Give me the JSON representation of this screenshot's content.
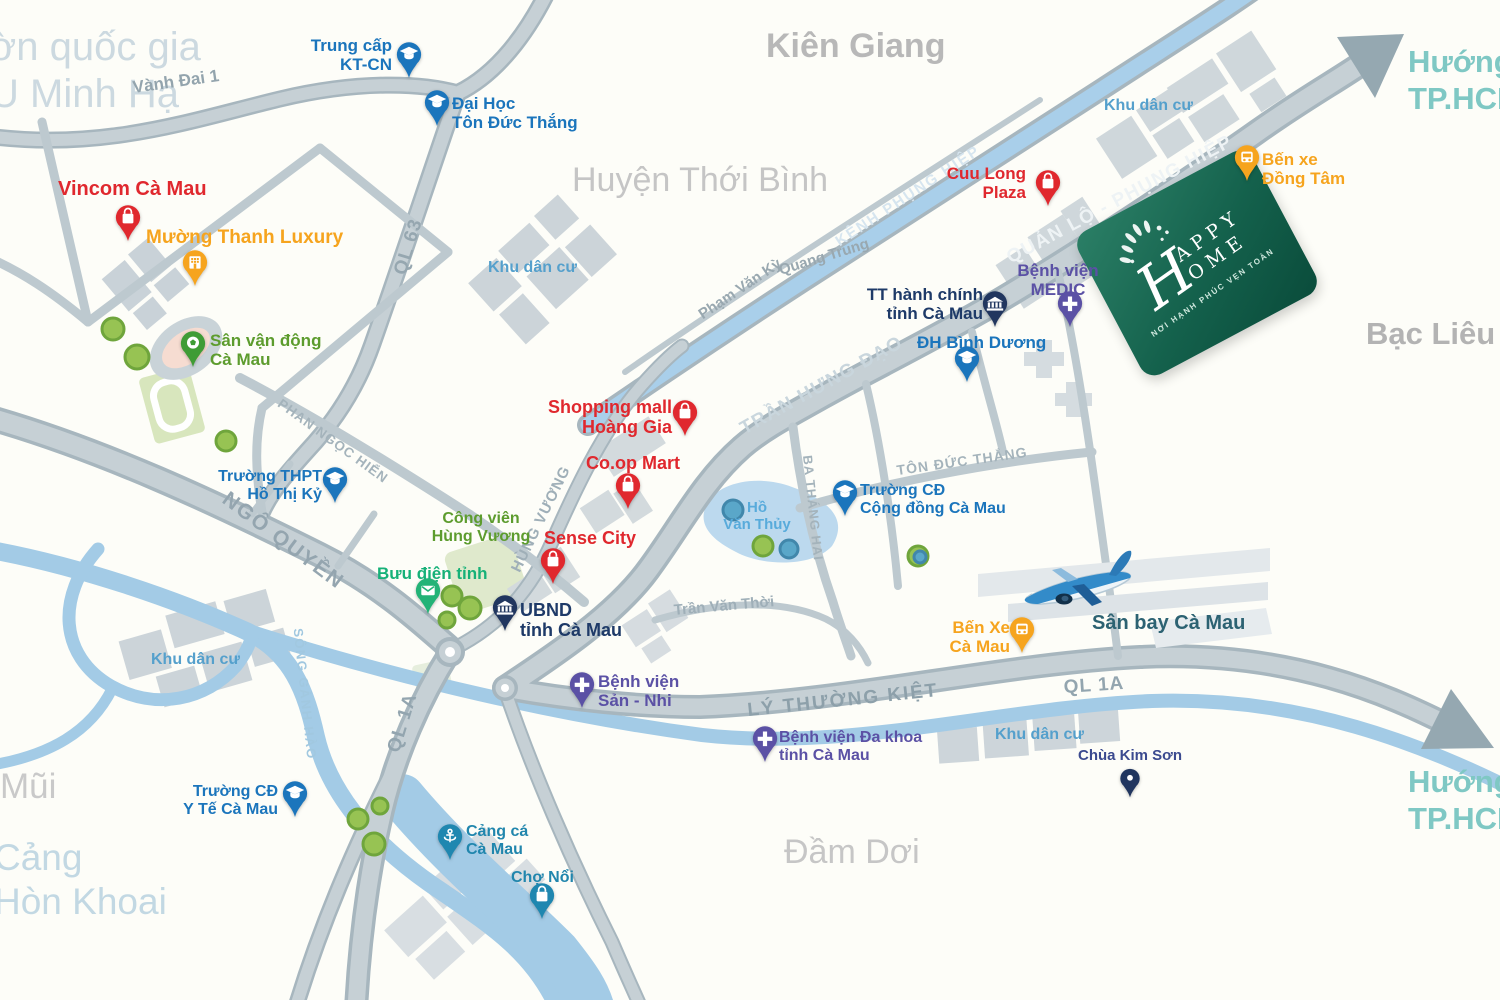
{
  "project": {
    "brand_initial": "H",
    "brand_line1": "APPY",
    "brand_line2": "OME",
    "tagline": "NƠI HẠNH PHÚC VẸN TOÀN"
  },
  "regions": {
    "national_park": "ờn quốc gia\nU Minh Hạ",
    "kien_giang": "Kiên Giang",
    "thoi_binh": "Huyện Thới Bình",
    "bac_lieu": "Bạc Liêu",
    "dam_doi": "Đầm Dơi",
    "mui": "Mũi",
    "hon_khoai": "Cảng\nHòn Khoai",
    "direction_hcm": "Hướng\nTP.HCM"
  },
  "roads": {
    "vanh_dai_1": "Vành Đai 1",
    "ql63": "QL 63",
    "kenh_phung_hiep": "KÊNH PHỤNG HIỆP",
    "pham_van_ky": "Phạm Văn Kỳ",
    "quang_trung": "Quang Trung",
    "quan_lo_phung_hiep": "QUẢN LỘ - PHỤNG HIỆP",
    "tran_hung_dao": "TRẦN HƯNG ĐẠO",
    "ngo_quyen": "NGÔ QUYỀN",
    "phan_ngoc_hien": "PHAN NGỌC HIỂN",
    "hung_vuong": "HÙNG VƯƠNG",
    "ba_thang_hai": "BA THÁNG HAI",
    "ton_duc_thang": "TÔN ĐỨC THẮNG",
    "tran_van_thoi": "Trần Văn Thời",
    "ly_thuong_kiet": "LÝ THƯỜNG KIỆT",
    "ql1a_east": "QL 1A",
    "ql1a_south": "QL 1A",
    "song_ganh_hao": "SÔNG GÀNH HÀO"
  },
  "areas": {
    "khu_dan_cu": "Khu dân cư",
    "ho_van_thuy": "Hồ\nVăn Thủy",
    "san_bay": "Sân bay Cà Mau"
  },
  "pois": {
    "trung_cap_ktcn": "Trung cấp\nKT-CN",
    "dh_ton_duc_thang": "Đại Học\nTôn Đức Thắng",
    "vincom": "Vincom Cà Mau",
    "muong_thanh": "Mường Thanh Luxury",
    "san_van_dong": "Sân vận động\nCà Mau",
    "thpt_ho_thi_ky": "Trường THPT\nHồ Thị Kỷ",
    "cong_vien_hung_vuong": "Công viên\nHùng Vương",
    "buu_dien": "Bưu điện tỉnh",
    "ubnd": "UBND\ntỉnh Cà Mau",
    "shopping_mall_hoang_gia": "Shopping mall\nHoàng Gia",
    "coop_mart": "Co.op Mart",
    "sense_city": "Sense City",
    "cuu_long_plaza": "Cuu Long\nPlaza",
    "tt_hanh_chinh": "TT hành chính\ntỉnh Cà Mau",
    "bv_medic": "Bệnh viện\nMEDIC",
    "dh_binh_duong": "ĐH Bình Dương",
    "cd_cong_dong": "Trường CĐ\nCộng đồng Cà Mau",
    "bv_san_nhi": "Bệnh viện\nSản - Nhi",
    "bv_da_khoa": "Bệnh viện Đa khoa\ntỉnh Cà Mau",
    "ben_xe_ca_mau": "Bến Xe\nCà Mau",
    "ben_xe_dong_tam": "Bến xe\nĐồng Tâm",
    "chua_kim_son": "Chùa Kim Sơn",
    "cd_y_te": "Trường CĐ\nY Tế Cà Mau",
    "cang_ca": "Cảng cá\nCà Mau",
    "cho_noi": "Chợ Nổi"
  },
  "colors": {
    "brand_green": "#11604b",
    "poi_education": "#1b75bc",
    "poi_shopping": "#e0282e",
    "poi_transport": "#f6a41e",
    "poi_medical": "#5b51a5",
    "poi_government": "#21365f",
    "poi_post": "#23b377",
    "poi_port": "#1f87b0",
    "poi_stadium": "#3f9c35",
    "water": "#a3cbe6",
    "road_fill": "#c6d0d5",
    "road_casing": "#a7b6be",
    "residential_label": "#55a0cc",
    "direction_label": "#7fc8c4"
  }
}
